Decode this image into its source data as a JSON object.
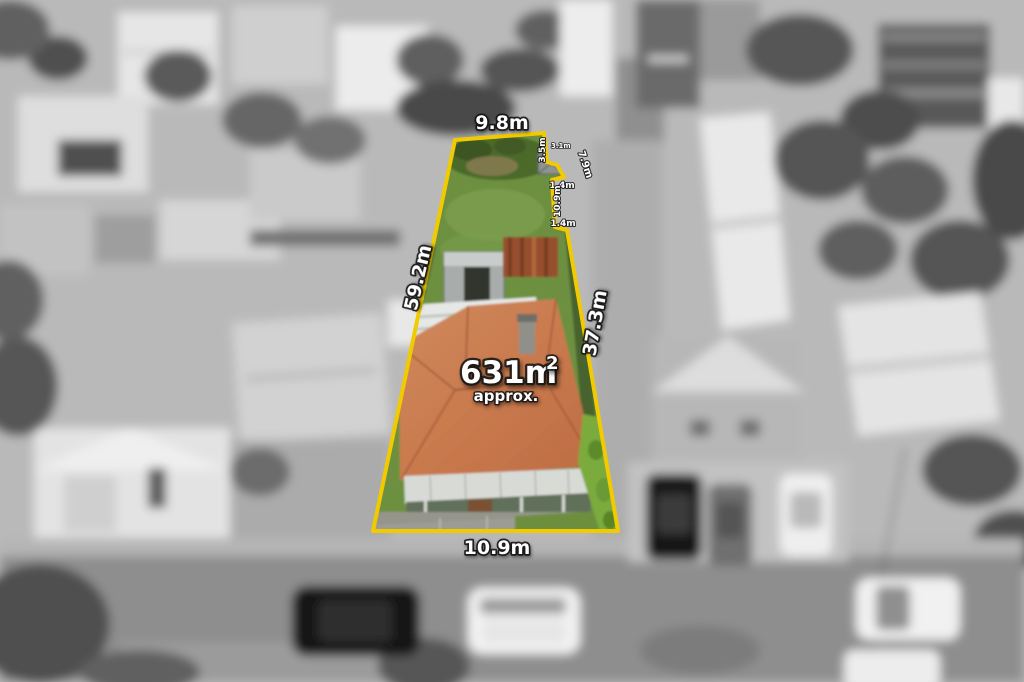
{
  "annotations": {
    "area": {
      "value": "631m",
      "superscript": "2",
      "qualifier": "approx."
    },
    "dimensions": {
      "top": "9.8m",
      "left": "59.2m",
      "right": "37.3m",
      "bottom": "10.9m",
      "notch": [
        "3.5m",
        "3.1m",
        "7.9m",
        "1.4m",
        "10.9m",
        "1.4m"
      ]
    },
    "colors": {
      "boundary_yellow": "#f1ca02",
      "label_fill": "#ffffff",
      "label_outline": "#141414",
      "lot_grass_green": "#6d9040",
      "roof_terracotta": "#c97a4e",
      "hedge_green": "#7cab3c"
    }
  }
}
